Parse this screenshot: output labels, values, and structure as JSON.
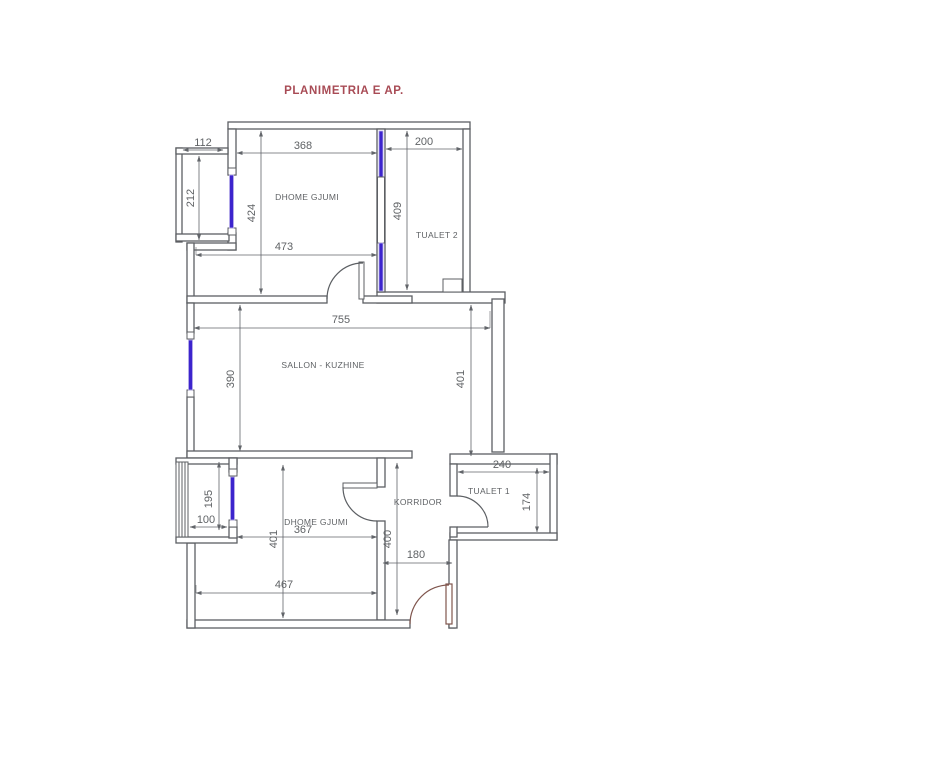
{
  "title": "PLANIMETRIA E AP.",
  "rooms": {
    "bedroom_top": "DHOME GJUMI",
    "toilet2": "TUALET 2",
    "salon": "SALLON - KUZHINE",
    "bedroom_bottom": "DHOME GJUMI",
    "corridor": "KORRIDOR",
    "toilet1": "TUALET 1"
  },
  "dims": {
    "balcony_top_width": "112",
    "bedroom_top_width": "368",
    "toilet2_width": "200",
    "balcony_top_height": "212",
    "bedroom_top_height": "424",
    "toilet2_height": "409",
    "bedroom_top_lower_width": "473",
    "salon_width": "755",
    "salon_height_left": "390",
    "salon_height_right": "401",
    "balcony_bottom_height": "195",
    "balcony_bottom_width": "100",
    "bedroom_bottom_width": "367",
    "bedroom_bottom_height": "401",
    "bedroom_bottom_total_width": "467",
    "corridor_height": "400",
    "corridor_width": "180",
    "toilet1_width": "240",
    "toilet1_height": "174"
  },
  "colors": {
    "wall": "#5c5f63",
    "window": "#3c24cd",
    "window_halo": "#b9b0ea",
    "door_entry": "#80564e",
    "dim": "#62656a",
    "text": "#5f6265",
    "title": "#a84b55"
  }
}
